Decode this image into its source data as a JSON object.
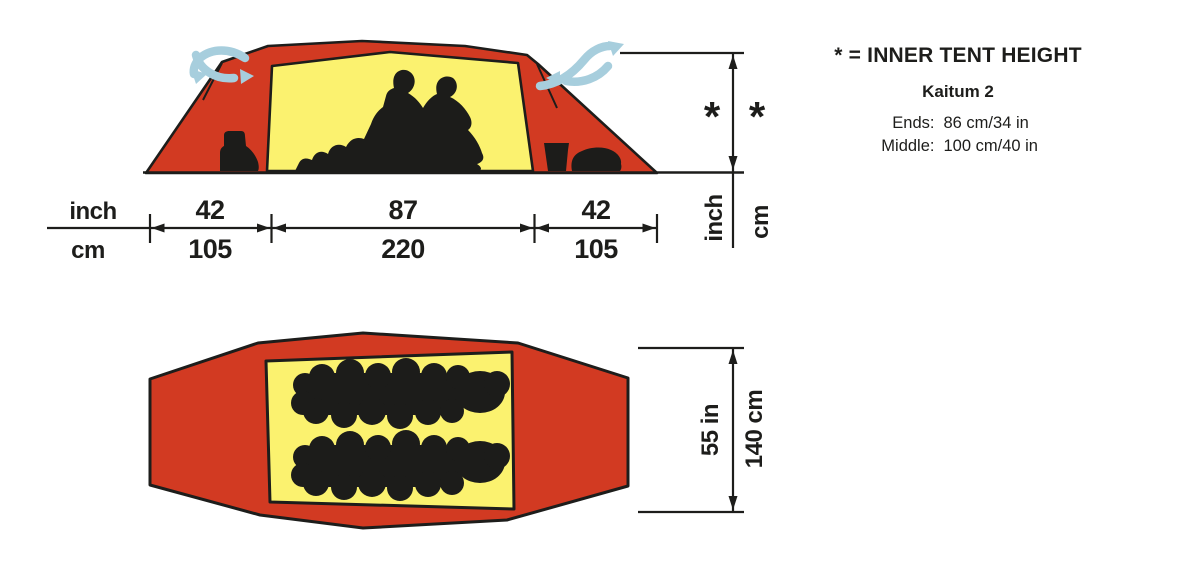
{
  "colors": {
    "fly_red": "#d23a22",
    "inner_yellow": "#fbf26f",
    "silhouette_black": "#1c1c1a",
    "vent_blue": "#a7cedd",
    "line_black": "#1d1d1b"
  },
  "legend": {
    "title": "* = INNER TENT HEIGHT",
    "model": "Kaitum 2",
    "specs": [
      {
        "label": "Ends:",
        "value": "86 cm/34 in"
      },
      {
        "label": "Middle:",
        "value": "100 cm/40 in"
      }
    ]
  },
  "side_view": {
    "horizontal": {
      "unit_top": "inch",
      "unit_bottom": "cm",
      "segments": [
        {
          "top": "42",
          "bottom": "105"
        },
        {
          "top": "87",
          "bottom": "220"
        },
        {
          "top": "42",
          "bottom": "105"
        }
      ]
    },
    "vertical": {
      "asterisk_left": "*",
      "asterisk_right": "*",
      "unit_left": "inch",
      "unit_right": "cm"
    }
  },
  "top_view": {
    "vertical": {
      "label_in": "55 in",
      "label_cm": "140 cm"
    }
  }
}
